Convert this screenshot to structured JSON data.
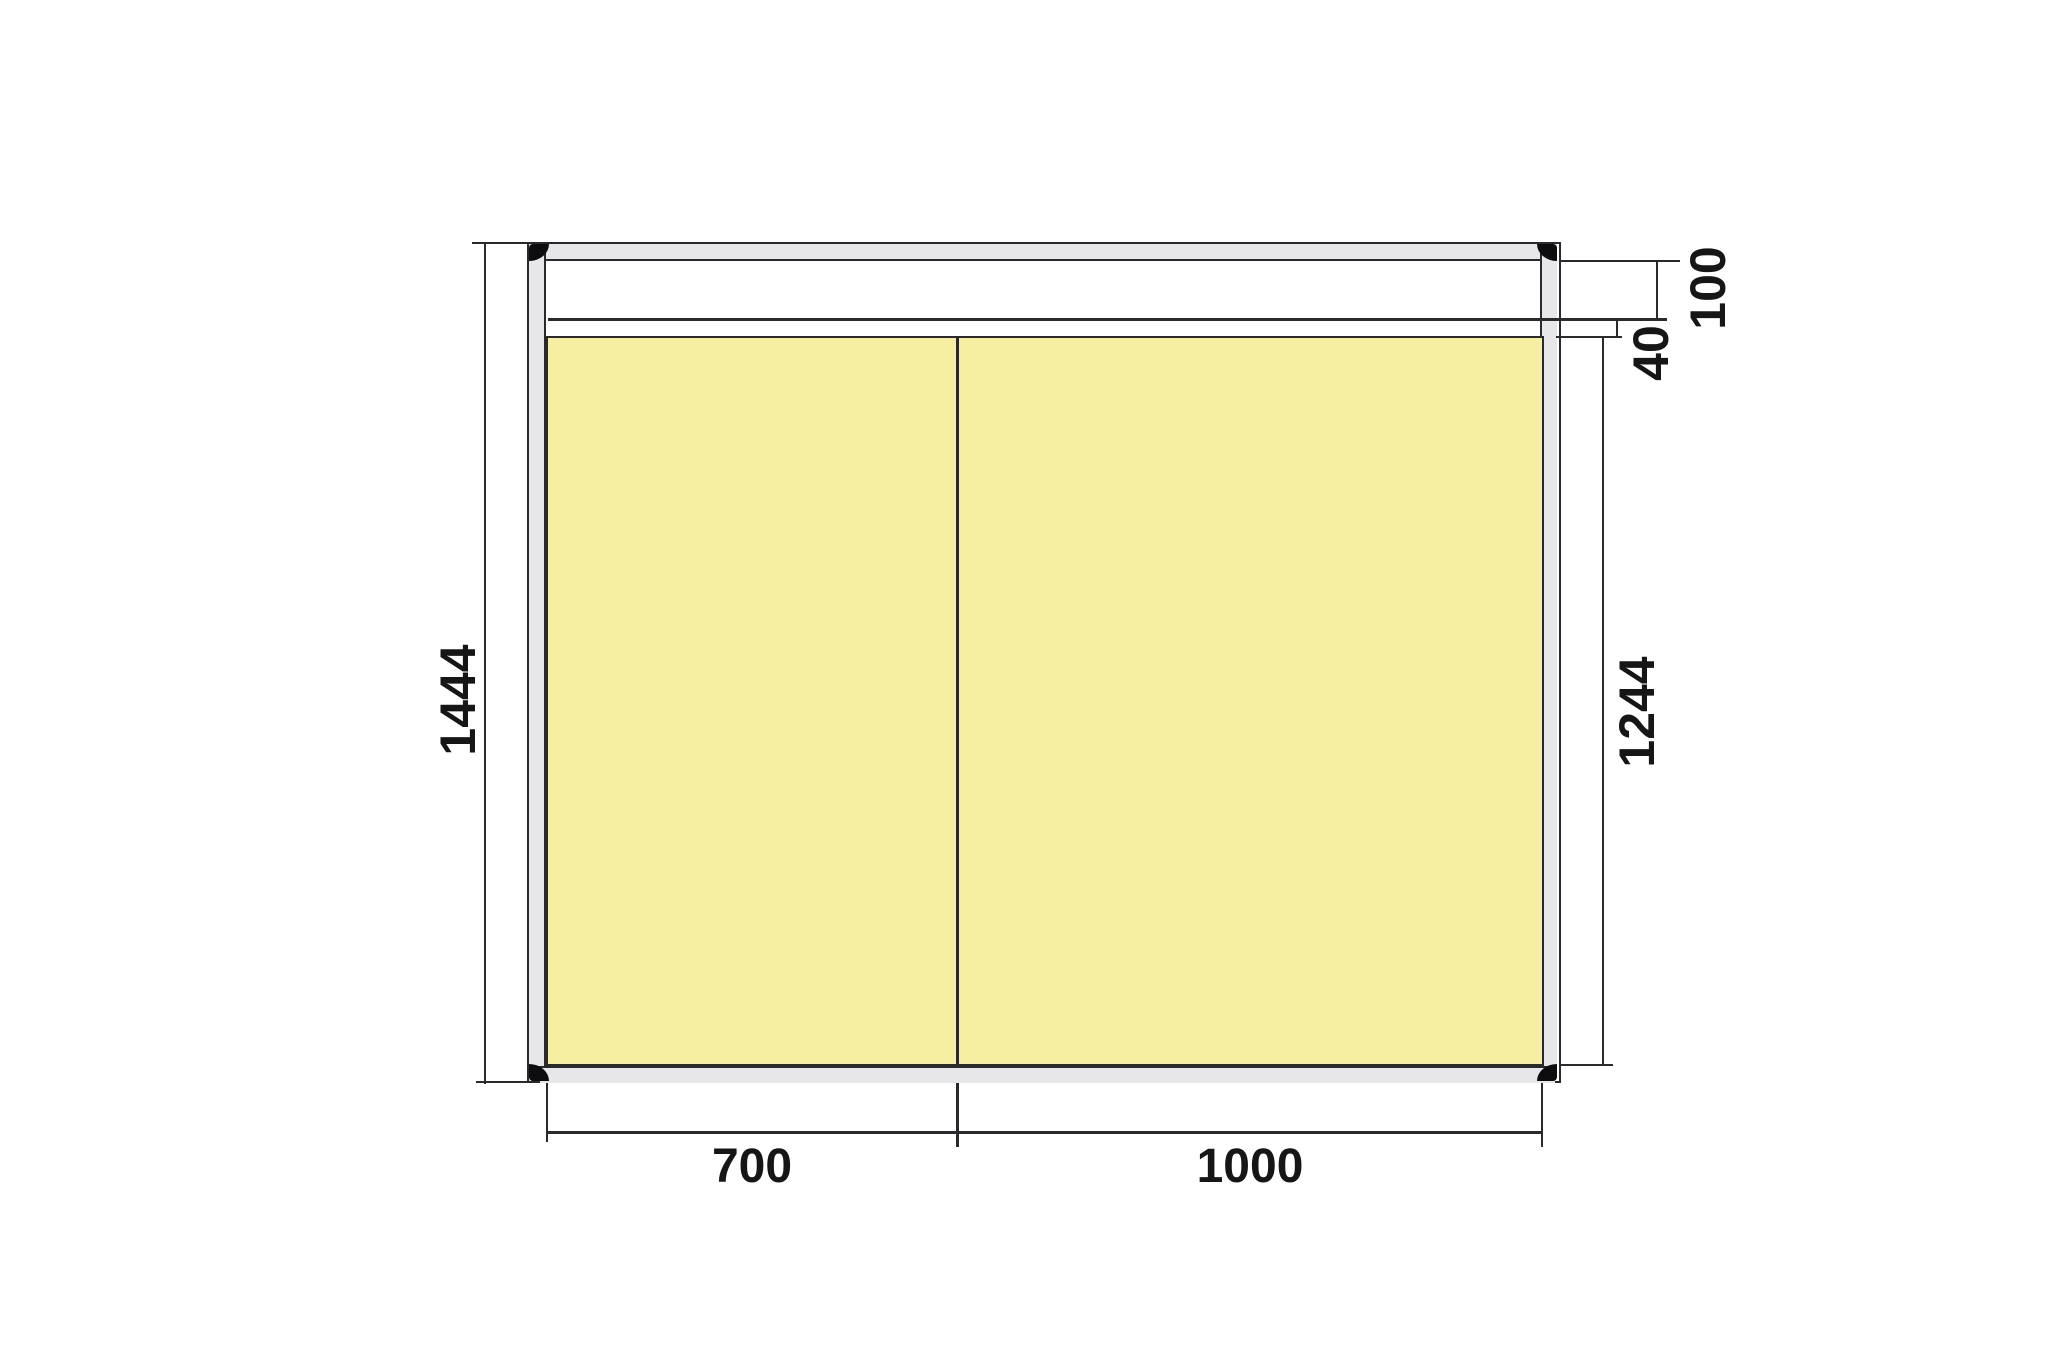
{
  "dimensions": {
    "overall_height": "1444",
    "display_area_height": "1244",
    "header_height": "100",
    "header_gap": "40",
    "left_panel_width": "700",
    "right_panel_width": "1000"
  },
  "colors": {
    "outline": "#2a2a2e",
    "frame": "#e7e7e9",
    "panel": "#f6efa1",
    "corner": "#0d0d0f",
    "text": "#161616",
    "bg": "#ffffff"
  }
}
